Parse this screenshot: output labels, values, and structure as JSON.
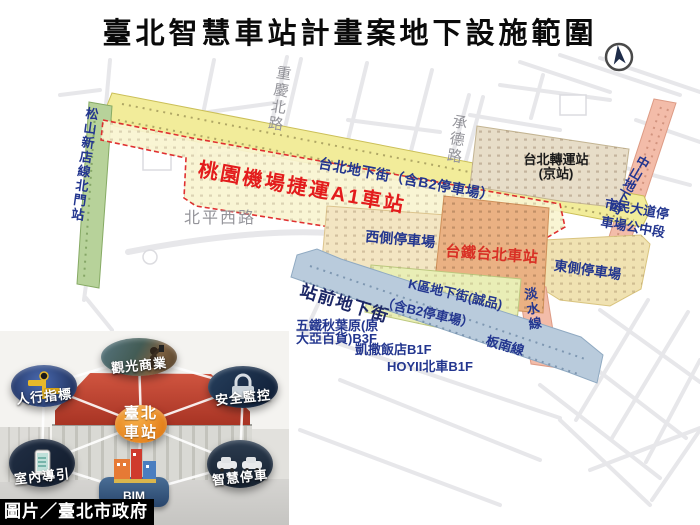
{
  "title": "臺北智慧車站計畫案地下設施範圍",
  "credit": "圖片／臺北市政府",
  "colors": {
    "underground_mall_yellow": "#f2ec9a",
    "a1_zone_fill": "#f9f4d0",
    "a1_dashed_border": "#e03030",
    "green_line_strip": "#b7d29a",
    "west_parking_cream": "#f3e5c2",
    "tra_station_orange": "#eab183",
    "bus_station_tan": "#e7ddc8",
    "east_parking_khaki": "#f0e2b2",
    "k_mall_green": "#e9eeb6",
    "metro_mall_blue": "#b9cbdc",
    "tamsui_line_pink": "#f3bca9",
    "label_blue": "#23368f",
    "label_red": "#d93025",
    "center_bubble_orange": "#ef8c1f"
  },
  "map": {
    "streets": {
      "chongqing_n_rd": "重慶北路",
      "chengde_rd": "承德路",
      "beiping_w_rd": "北平西路"
    },
    "labels": {
      "taipei_mall": "台北地下街（含B2停車場）",
      "airport_a1": "桃園機場捷運A1車站",
      "songshan_beimen": "松山新店線北門站",
      "west_parking": "西側停車場",
      "tra_station": "台鐵台北車站",
      "bus_station_line1": "台北轉運站",
      "bus_station_line2": "(京站)",
      "zhongshan_mall": "中山地下街",
      "civic_parking_line1": "市民大道停",
      "civic_parking_line2": "車場公中段",
      "east_parking": "東側停車場",
      "k_mall_line1": "K區地下街(誠品)",
      "k_mall_line2": "（含B2停車場）",
      "tamsui_line": "淡水線",
      "front_mall": "站前地下街",
      "bannan_line": "板南線",
      "qsquare_line1": "五鐵秋葉原(原",
      "qsquare_line2": "大亞百貨)B3F",
      "caesar": "凱撒飯店B1F",
      "hoyii": "HOYII北車B1F"
    }
  },
  "inset": {
    "center_line1": "臺北",
    "center_line2": "車站",
    "bim": "BIM",
    "bubbles": [
      {
        "label": "觀光商業"
      },
      {
        "label": "人行指標"
      },
      {
        "label": "安全監控"
      },
      {
        "label": "室內導引"
      },
      {
        "label": "智慧停車"
      }
    ]
  }
}
